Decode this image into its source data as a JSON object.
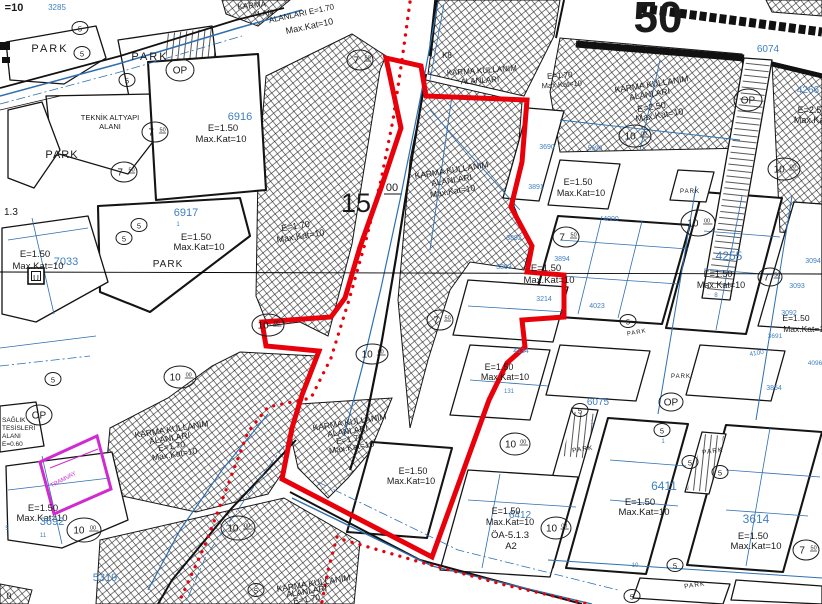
{
  "map": {
    "kind": "zoning-cadastral-plan",
    "colors": {
      "ink_black": "#1a1a1a",
      "parcel_number_blue": "#3f7fc1",
      "cadastral_blue": "#2e6fb0",
      "boundary_red": "#e8000a",
      "tram_magenta": "#cf2bcf"
    },
    "labels": [
      {
        "t": "=10",
        "x": 14,
        "y": 11,
        "s": 11,
        "w": 1
      },
      {
        "t": "3285",
        "x": 57,
        "y": 10,
        "s": 8,
        "c": "b"
      },
      {
        "t": "PARK",
        "x": 50,
        "y": 52,
        "s": 11,
        "ls": 2
      },
      {
        "t": "PARK",
        "x": 150,
        "y": 60,
        "s": 11,
        "ls": 2
      },
      {
        "t": "KARMA",
        "x": 252,
        "y": 8,
        "s": 8,
        "r": -6
      },
      {
        "t": "ALAN",
        "x": 263,
        "y": 16,
        "s": 8,
        "r": -6
      },
      {
        "t": "TEKNİK ALTYAPI",
        "x": 110,
        "y": 120,
        "s": 7.5
      },
      {
        "t": "ALANI",
        "x": 110,
        "y": 129,
        "s": 7.5
      },
      {
        "t": "6916",
        "x": 240,
        "y": 120,
        "s": 11,
        "c": "b"
      },
      {
        "t": "E=1.50",
        "x": 223,
        "y": 131,
        "s": 9.5
      },
      {
        "t": "Max.Kat=10",
        "x": 221,
        "y": 142,
        "s": 9.5
      },
      {
        "t": "PARK",
        "x": 62,
        "y": 158,
        "s": 11,
        "ls": 1
      },
      {
        "t": "ALANLARI E=1.70",
        "x": 302,
        "y": 16,
        "s": 8,
        "r": -12
      },
      {
        "t": "Max.Kat=10",
        "x": 310,
        "y": 29,
        "s": 9,
        "r": -12
      },
      {
        "t": "K8",
        "x": 447,
        "y": 58,
        "s": 8
      },
      {
        "t": "KARMA KULLANIM",
        "x": 482,
        "y": 73,
        "s": 8,
        "r": -4
      },
      {
        "t": "ALANLARI",
        "x": 480,
        "y": 83,
        "s": 8,
        "r": -4
      },
      {
        "t": "E=1.70",
        "x": 560,
        "y": 78,
        "s": 8,
        "r": -4
      },
      {
        "t": "Max.Kat=10",
        "x": 562,
        "y": 87,
        "s": 7.5,
        "r": -4
      },
      {
        "t": "50",
        "x": 658,
        "y": 32,
        "s": 44,
        "w": 1
      },
      {
        "t": "6074",
        "x": 768,
        "y": 52,
        "s": 10,
        "c": "b"
      },
      {
        "t": "KARMA KULLANIM",
        "x": 652,
        "y": 87,
        "s": 8.5,
        "r": -9
      },
      {
        "t": "ALANLARI",
        "x": 650,
        "y": 97,
        "s": 8.5,
        "r": -9
      },
      {
        "t": "E=2.50",
        "x": 652,
        "y": 110,
        "s": 9,
        "r": -9
      },
      {
        "t": "Max.Kat=10",
        "x": 660,
        "y": 118,
        "s": 9,
        "r": -9
      },
      {
        "t": "4266",
        "x": 808,
        "y": 93,
        "s": 10,
        "c": "b"
      },
      {
        "t": "E=2.50",
        "x": 812,
        "y": 113,
        "s": 9
      },
      {
        "t": "Max.Kat=10",
        "x": 818,
        "y": 123,
        "s": 9
      },
      {
        "t": "1.3",
        "x": 4,
        "y": 215,
        "s": 10,
        "a": "s"
      },
      {
        "t": "6917",
        "x": 186,
        "y": 216,
        "s": 11,
        "c": "b"
      },
      {
        "t": "1",
        "x": 178,
        "y": 226,
        "s": 6,
        "c": "b"
      },
      {
        "t": "E=1.50",
        "x": 196,
        "y": 240,
        "s": 9.5
      },
      {
        "t": "Max.Kat=10",
        "x": 199,
        "y": 250,
        "s": 9.5
      },
      {
        "t": "E=1.50",
        "x": 35,
        "y": 257,
        "s": 9.5
      },
      {
        "t": "7033",
        "x": 66,
        "y": 265,
        "s": 11,
        "c": "b"
      },
      {
        "t": "Max.Kat=10",
        "x": 38,
        "y": 269,
        "s": 9.5
      },
      {
        "t": "PARK",
        "x": 168,
        "y": 267,
        "s": 10,
        "ls": 1
      },
      {
        "t": "KARMA KULLANIM",
        "x": 452,
        "y": 173,
        "s": 8.5,
        "r": -9
      },
      {
        "t": "ALANLARI",
        "x": 452,
        "y": 183,
        "s": 8.5,
        "r": -9
      },
      {
        "t": "Max.Kat=10",
        "x": 453,
        "y": 194,
        "s": 8.5,
        "r": -9
      },
      {
        "t": "3891",
        "x": 536,
        "y": 189,
        "s": 7,
        "c": "b"
      },
      {
        "t": "3690",
        "x": 547,
        "y": 149,
        "s": 7,
        "c": "b"
      },
      {
        "t": "5690",
        "x": 595,
        "y": 150,
        "s": 6.5,
        "c": "b"
      },
      {
        "t": "E=1.50",
        "x": 578,
        "y": 185,
        "s": 9
      },
      {
        "t": "Max.Kat=10",
        "x": 581,
        "y": 196,
        "s": 9
      },
      {
        "t": "PARK",
        "x": 690,
        "y": 193,
        "s": 6,
        "ls": 1
      },
      {
        "t": "E=1.70",
        "x": 296,
        "y": 229,
        "s": 9,
        "r": -9
      },
      {
        "t": "Max.Kat=10",
        "x": 301,
        "y": 239,
        "s": 9,
        "r": -9
      },
      {
        "t": "15",
        "x": 356,
        "y": 212,
        "s": 27
      },
      {
        "t": "00",
        "x": 392,
        "y": 191,
        "s": 11
      },
      {
        "t": "4000",
        "x": 611,
        "y": 221,
        "s": 7,
        "c": "b"
      },
      {
        "t": "3892",
        "x": 514,
        "y": 240,
        "s": 7,
        "c": "b"
      },
      {
        "t": "3894",
        "x": 562,
        "y": 261,
        "s": 7,
        "c": "b"
      },
      {
        "t": "3893",
        "x": 504,
        "y": 269,
        "s": 7,
        "c": "b"
      },
      {
        "t": "E=1.50",
        "x": 546,
        "y": 271,
        "s": 9.5
      },
      {
        "t": "Max.Kat=10",
        "x": 549,
        "y": 283,
        "s": 9.5
      },
      {
        "t": "4255",
        "x": 729,
        "y": 260,
        "s": 12,
        "c": "b"
      },
      {
        "t": "E=1.50",
        "x": 718,
        "y": 277,
        "s": 9
      },
      {
        "t": "Max.Kat=10",
        "x": 721,
        "y": 288,
        "s": 9
      },
      {
        "t": "8",
        "x": 716,
        "y": 297,
        "s": 6,
        "c": "b"
      },
      {
        "t": "3094",
        "x": 813,
        "y": 263,
        "s": 7,
        "c": "b"
      },
      {
        "t": "3093",
        "x": 797,
        "y": 288,
        "s": 7,
        "c": "b"
      },
      {
        "t": "3214",
        "x": 544,
        "y": 301,
        "s": 7,
        "c": "b"
      },
      {
        "t": "4023",
        "x": 597,
        "y": 308,
        "s": 7,
        "c": "b"
      },
      {
        "t": "3092",
        "x": 789,
        "y": 315,
        "s": 7,
        "c": "b"
      },
      {
        "t": "E=1.50",
        "x": 796,
        "y": 321,
        "s": 8.5
      },
      {
        "t": "Max.Kat=10",
        "x": 806,
        "y": 332,
        "s": 8.5
      },
      {
        "t": "3691",
        "x": 775,
        "y": 338,
        "s": 6.5,
        "c": "b"
      },
      {
        "t": "PARK",
        "x": 637,
        "y": 334,
        "s": 6,
        "ls": 1,
        "r": -10
      },
      {
        "t": "4100",
        "x": 757,
        "y": 355,
        "s": 6.5,
        "c": "b",
        "r": -10
      },
      {
        "t": "4134",
        "x": 521,
        "y": 353,
        "s": 7,
        "c": "b"
      },
      {
        "t": "E=1.50",
        "x": 499,
        "y": 370,
        "s": 9
      },
      {
        "t": "Max.Kat=10",
        "x": 505,
        "y": 380,
        "s": 9
      },
      {
        "t": "4096",
        "x": 815,
        "y": 365,
        "s": 6.5,
        "c": "b"
      },
      {
        "t": "PARK",
        "x": 681,
        "y": 378,
        "s": 6,
        "ls": 1
      },
      {
        "t": "3854",
        "x": 774,
        "y": 390,
        "s": 7,
        "c": "b"
      },
      {
        "t": "6075",
        "x": 598,
        "y": 405,
        "s": 10,
        "c": "b"
      },
      {
        "t": "131",
        "x": 509,
        "y": 393,
        "s": 6,
        "c": "b"
      },
      {
        "t": "1",
        "x": 592,
        "y": 424,
        "s": 6,
        "c": "b"
      },
      {
        "t": "1",
        "x": 663,
        "y": 443,
        "s": 6,
        "c": "b"
      },
      {
        "t": "KARMA KULLANIM",
        "x": 172,
        "y": 432,
        "s": 8.5,
        "r": -9
      },
      {
        "t": "ALANLARI",
        "x": 170,
        "y": 441,
        "s": 8.5,
        "r": -9
      },
      {
        "t": "E=1.70",
        "x": 172,
        "y": 449,
        "s": 8.5,
        "r": -9
      },
      {
        "t": "Max.Kat=10",
        "x": 175,
        "y": 457,
        "s": 8.5,
        "r": -9
      },
      {
        "t": "KARMA KULLANIM",
        "x": 350,
        "y": 425,
        "s": 8.5,
        "r": -9
      },
      {
        "t": "ALANLARI",
        "x": 348,
        "y": 434,
        "s": 8.5,
        "r": -9
      },
      {
        "t": "E=1.70",
        "x": 350,
        "y": 442,
        "s": 8.5,
        "r": -9
      },
      {
        "t": "Max.Kat=10",
        "x": 352,
        "y": 450,
        "s": 8.5,
        "r": -9
      },
      {
        "t": "SAĞLIK",
        "x": 2,
        "y": 422,
        "s": 6.5,
        "a": "s"
      },
      {
        "t": "TESİSLERİ",
        "x": 2,
        "y": 430,
        "s": 6.5,
        "a": "s"
      },
      {
        "t": "ALANI",
        "x": 2,
        "y": 438,
        "s": 6.5,
        "a": "s"
      },
      {
        "t": "E=0.60",
        "x": 2,
        "y": 446,
        "s": 6.5,
        "a": "s"
      },
      {
        "t": "E=1.50",
        "x": 413,
        "y": 474,
        "s": 9
      },
      {
        "t": "Max.Kat=10",
        "x": 411,
        "y": 484,
        "s": 9
      },
      {
        "t": "PARK",
        "x": 583,
        "y": 451,
        "s": 6.5,
        "ls": 1,
        "r": -8
      },
      {
        "t": "PARK",
        "x": 713,
        "y": 453,
        "s": 6.5,
        "ls": 1,
        "r": -8
      },
      {
        "t": "E=1.50",
        "x": 640,
        "y": 505,
        "s": 9.5
      },
      {
        "t": "Max.Kat=10",
        "x": 644,
        "y": 515,
        "s": 9.5
      },
      {
        "t": "6411",
        "x": 664,
        "y": 490,
        "s": 12,
        "c": "b"
      },
      {
        "t": "6412",
        "x": 520,
        "y": 518,
        "s": 10,
        "c": "b"
      },
      {
        "t": "E=1.50",
        "x": 506,
        "y": 514,
        "s": 9
      },
      {
        "t": "Max.Kat=10",
        "x": 510,
        "y": 525,
        "s": 9
      },
      {
        "t": "ÖA-5.1.3",
        "x": 510,
        "y": 538,
        "s": 9.5
      },
      {
        "t": "A2",
        "x": 511,
        "y": 549,
        "s": 9.5
      },
      {
        "t": "3614",
        "x": 756,
        "y": 523,
        "s": 12,
        "c": "b"
      },
      {
        "t": "E=1.50",
        "x": 753,
        "y": 539,
        "s": 9.5
      },
      {
        "t": "Max.Kat=10",
        "x": 756,
        "y": 549,
        "s": 9.5
      },
      {
        "t": "E=1.50",
        "x": 43,
        "y": 511,
        "s": 9.5
      },
      {
        "t": "Max.Kat=10",
        "x": 42,
        "y": 521,
        "s": 9.5
      },
      {
        "t": "3692",
        "x": 52,
        "y": 525,
        "s": 11,
        "c": "b"
      },
      {
        "t": "11",
        "x": 43,
        "y": 537,
        "s": 6,
        "c": "b"
      },
      {
        "t": "5",
        "x": 7,
        "y": 530,
        "s": 6,
        "c": "b"
      },
      {
        "t": "5319",
        "x": 105,
        "y": 581,
        "s": 11,
        "c": "b"
      },
      {
        "t": "TRAMVAY",
        "x": 64,
        "y": 481,
        "s": 6,
        "c": "m",
        "r": -28
      },
      {
        "t": "KARMA KULLANIM",
        "x": 314,
        "y": 586,
        "s": 8.5,
        "r": -9
      },
      {
        "t": "ALANLARI",
        "x": 307,
        "y": 594,
        "s": 8.5,
        "r": -9
      },
      {
        "t": "E=1.70",
        "x": 307,
        "y": 602,
        "s": 8.5,
        "r": -9
      },
      {
        "t": "10",
        "x": 635,
        "y": 567,
        "s": 6,
        "c": "b"
      },
      {
        "t": "PARK",
        "x": 695,
        "y": 587,
        "s": 6.5,
        "ls": 1,
        "r": -8
      },
      {
        "t": "0",
        "x": 9,
        "y": 599,
        "s": 9
      },
      {
        "t": "U",
        "x": 36,
        "y": 281,
        "s": 8
      }
    ],
    "road_width_circles": [
      {
        "x": 80,
        "y": 28,
        "rx": 8,
        "ry": 6.5,
        "m": "5"
      },
      {
        "x": 82,
        "y": 53,
        "rx": 8,
        "ry": 6.5,
        "m": "5"
      },
      {
        "x": 127,
        "y": 80,
        "rx": 8,
        "ry": 6.5,
        "m": "5"
      },
      {
        "x": 155,
        "y": 132,
        "rx": 13,
        "ry": 10,
        "m": "7",
        "sup": "50"
      },
      {
        "x": 124,
        "y": 172,
        "rx": 13,
        "ry": 10,
        "m": "7",
        "sup": "50"
      },
      {
        "x": 360,
        "y": 60,
        "rx": 13,
        "ry": 10,
        "m": "7",
        "sup": "50"
      },
      {
        "x": 180,
        "y": 70,
        "rx": 14,
        "ry": 11,
        "m": "OP"
      },
      {
        "x": 748,
        "y": 100,
        "rx": 14,
        "ry": 11,
        "m": "OP"
      },
      {
        "x": 39,
        "y": 415,
        "rx": 13,
        "ry": 10,
        "m": "OP"
      },
      {
        "x": 671,
        "y": 402,
        "rx": 12,
        "ry": 9,
        "m": "OP"
      },
      {
        "x": 635,
        "y": 136,
        "rx": 16,
        "ry": 11,
        "m": "10",
        "sup": "00"
      },
      {
        "x": 784,
        "y": 169,
        "rx": 16,
        "ry": 11,
        "m": "10",
        "sup": "00"
      },
      {
        "x": 268,
        "y": 325,
        "rx": 16,
        "ry": 11,
        "m": "10",
        "sup": "00"
      },
      {
        "x": 180,
        "y": 377,
        "rx": 16,
        "ry": 11,
        "m": "10",
        "sup": "00"
      },
      {
        "x": 84,
        "y": 530,
        "rx": 17,
        "ry": 12,
        "m": "10",
        "sup": "00"
      },
      {
        "x": 238,
        "y": 528,
        "rx": 17,
        "ry": 12,
        "m": "10",
        "sup": "00"
      },
      {
        "x": 698,
        "y": 223,
        "rx": 17,
        "ry": 13,
        "m": "10",
        "sup": "00"
      },
      {
        "x": 515,
        "y": 444,
        "rx": 15,
        "ry": 11,
        "m": "10",
        "sup": "00"
      },
      {
        "x": 556,
        "y": 528,
        "rx": 15,
        "ry": 11,
        "m": "10",
        "sup": "00"
      },
      {
        "x": 372,
        "y": 354,
        "rx": 16,
        "ry": 10,
        "m": "10",
        "sup": "00"
      },
      {
        "x": 440,
        "y": 320,
        "rx": 13,
        "ry": 10,
        "m": "7",
        "sup": "50"
      },
      {
        "x": 566,
        "y": 237,
        "rx": 13,
        "ry": 10,
        "m": "7",
        "sup": "50"
      },
      {
        "x": 770,
        "y": 277,
        "rx": 12,
        "ry": 9,
        "m": "7",
        "sup": "50"
      },
      {
        "x": 806,
        "y": 550,
        "rx": 13,
        "ry": 10,
        "m": "7",
        "sup": "50"
      },
      {
        "x": 139,
        "y": 225,
        "rx": 8,
        "ry": 6.5,
        "m": "5"
      },
      {
        "x": 124,
        "y": 238,
        "rx": 8,
        "ry": 6.5,
        "m": "5"
      },
      {
        "x": 53,
        "y": 379,
        "rx": 8,
        "ry": 6.5,
        "m": "5"
      },
      {
        "x": 628,
        "y": 321,
        "rx": 8,
        "ry": 6.5,
        "m": "5"
      },
      {
        "x": 662,
        "y": 430,
        "rx": 8,
        "ry": 6.5,
        "m": "5"
      },
      {
        "x": 690,
        "y": 462,
        "rx": 8,
        "ry": 6.5,
        "m": "5"
      },
      {
        "x": 720,
        "y": 472,
        "rx": 8,
        "ry": 6.5,
        "m": "5"
      },
      {
        "x": 675,
        "y": 565,
        "rx": 8,
        "ry": 6.5,
        "m": "5"
      },
      {
        "x": 632,
        "y": 596,
        "rx": 8,
        "ry": 6.5,
        "m": "5"
      },
      {
        "x": 580,
        "y": 410,
        "rx": 8,
        "ry": 6.5,
        "m": "5"
      },
      {
        "x": 256,
        "y": 590,
        "rx": 8,
        "ry": 6.5,
        "m": "5"
      }
    ]
  }
}
